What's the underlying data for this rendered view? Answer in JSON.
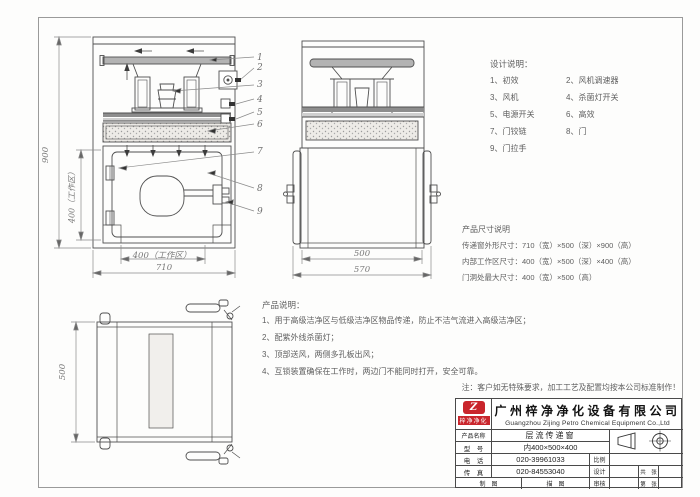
{
  "drawing": {
    "design_notes": {
      "title": "设计说明：",
      "items_left": [
        "1、初效",
        "3、风机",
        "5、电源开关",
        "7、门铰链",
        "9、门拉手"
      ],
      "items_right": [
        "2、风机调速器",
        "4、杀菌灯开关",
        "6、高效",
        "8、门"
      ]
    },
    "size_notes": {
      "title": "产品尺寸说明",
      "lines": [
        "传递窗外形尺寸：710（宽）×500（深）×900（高）",
        "内部工作区尺寸：400（宽）×500（深）×400（高）",
        "门洞处最大尺寸：400（宽）×500（高）"
      ]
    },
    "product_notes": {
      "title": "产品说明：",
      "lines": [
        "1、用于高级洁净区与低级洁净区物品传递，防止不洁气流进入高级洁净区；",
        "2、配紫外线杀菌灯；",
        "3、顶部送风，两侧多孔板出风；",
        "4、互锁装置确保在工作时，两边门不能同时打开，安全可靠。"
      ]
    },
    "footnote": "注：客户如无特殊要求，加工工艺及配置均按本公司标准制作！",
    "dimensions": {
      "front_height": "900",
      "front_inner_height": "400（工作区）",
      "front_inner_width": "400（工作区）",
      "front_width": "710",
      "side_inner_width": "500",
      "side_outer_width": "570",
      "top_depth": "500"
    },
    "callouts": [
      "1",
      "2",
      "3",
      "4",
      "5",
      "6",
      "7",
      "8",
      "9"
    ]
  },
  "title_block": {
    "logo_text": "梓净净化",
    "logo_glyph": "Z",
    "company_cn": "广州梓净净化设备有限公司",
    "company_en": "Guangzhou Zijing Petro Chemical Equipment Co.,Ltd",
    "rows": {
      "product_label": "产品名称",
      "product_value": "层流传递窗",
      "model_label": "型　号",
      "model_value": "内400×500×400",
      "tel_label": "电　话",
      "tel_value": "020-39961033",
      "fax_label": "传　真",
      "fax_value": "020-84553040",
      "scale_label": "比例",
      "design_label": "设计",
      "check_label": "审核",
      "draft_label": "制　图",
      "trace_label": "描　图",
      "sheets_label": "共　张",
      "sheetno_label": "第　张"
    }
  }
}
